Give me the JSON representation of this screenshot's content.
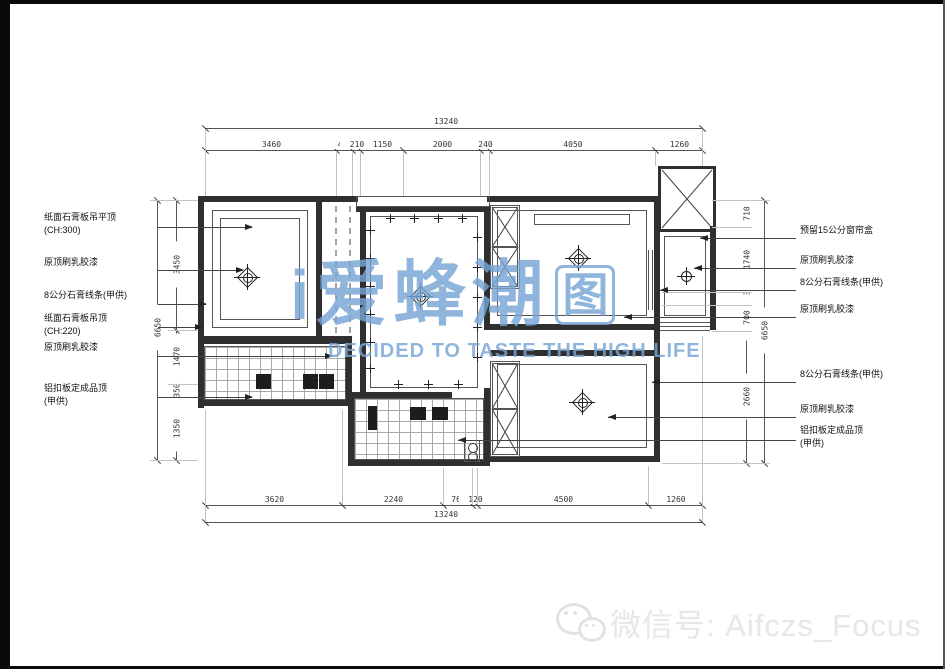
{
  "drawing": {
    "type": "ceiling-plan",
    "dimensions": {
      "top": {
        "total": "13240",
        "segments": [
          "3460",
          "420",
          "210",
          "1150",
          "2000",
          "240",
          "4050",
          "1260"
        ]
      },
      "bottom": {
        "total": "13240",
        "segments": [
          "3620",
          "2240",
          "760",
          "120",
          "4500",
          "1260"
        ]
      },
      "left": {
        "overall": "6650",
        "segments": [
          "3450",
          "1470",
          "350",
          "1350"
        ]
      },
      "right": {
        "overall": "6650",
        "segments": [
          "710",
          "1740",
          "340",
          "700",
          "2660"
        ]
      }
    },
    "annotations": {
      "left": [
        [
          "纸面石膏板吊平顶",
          "(CH:300)"
        ],
        [
          "原顶刷乳胶漆"
        ],
        [
          "8公分石膏线条(甲供)"
        ],
        [
          "纸面石膏板吊顶",
          "(CH:220)"
        ],
        [
          "原顶刷乳胶漆"
        ],
        [
          "铝扣板定成品顶",
          "(甲供)"
        ]
      ],
      "right": [
        [
          "预留15公分窗帘盒"
        ],
        [
          "原顶刷乳胶漆"
        ],
        [
          "8公分石膏线条(甲供)"
        ],
        [
          "原顶刷乳胶漆"
        ],
        [
          "8公分石膏线条(甲供)"
        ],
        [
          "原顶刷乳胶漆"
        ],
        [
          "铝扣板定成品顶",
          "(甲供)"
        ]
      ]
    }
  },
  "watermark": {
    "leading": "i",
    "brand": "爱蜂潮",
    "boxed_glyph": "图",
    "tagline": "DECIDED TO TASTE THE HIGH LIFE",
    "color": "#78a5d4"
  },
  "footer": {
    "wechat_text": "微信号: Aifczs_Focus"
  },
  "colors": {
    "line": "#2f2f2f",
    "frame": "#0a0a0a",
    "watermark_blue": "#78a5d4",
    "footer_gray": "#e7e7e7"
  }
}
